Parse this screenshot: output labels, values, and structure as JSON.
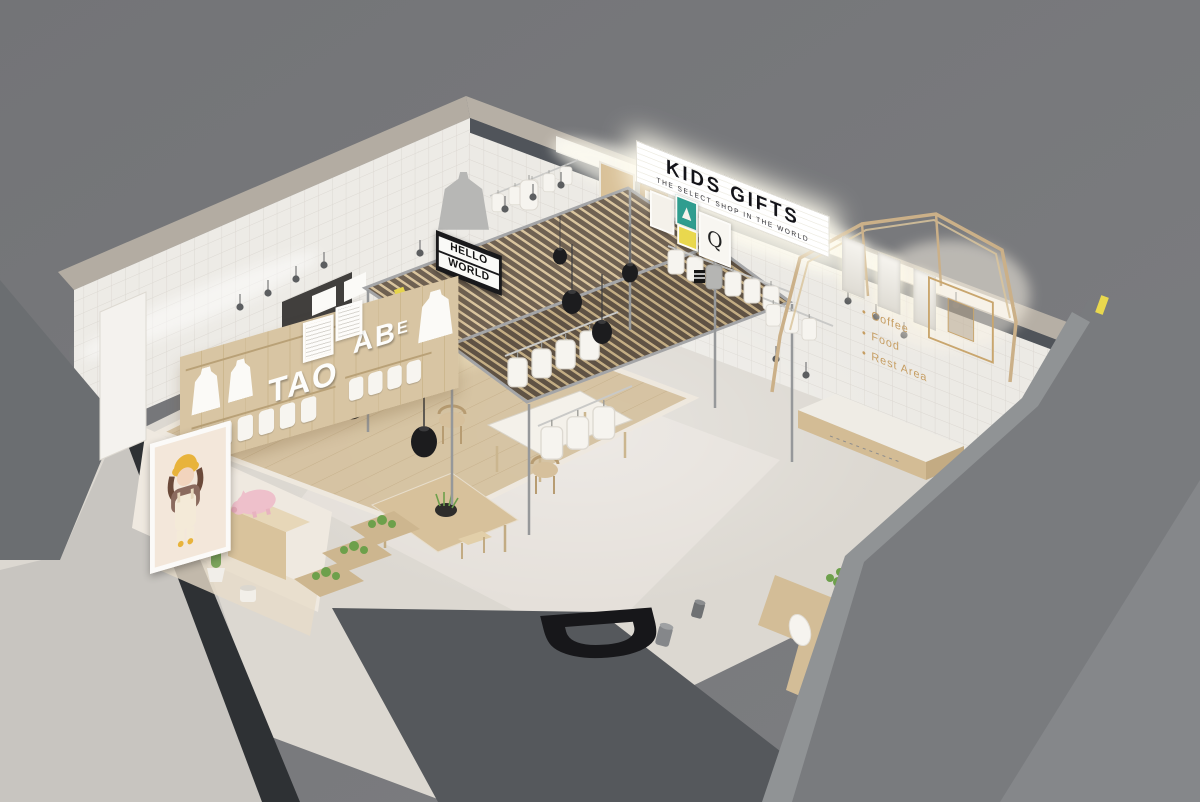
{
  "scene": {
    "description": "3D cutaway interior render of a kids' select shop"
  },
  "signs": {
    "marquee": {
      "title": "KIDS GIFTS",
      "subtitle": "THE SELECT SHOP IN THE WORLD"
    },
    "hanging": {
      "line1": "HELLO",
      "line2": "WORLD"
    },
    "display_letters": {
      "group1": "TAO",
      "group2": "AB",
      "group2_small": "E"
    },
    "artwork_letter": "Q",
    "amenity_list": {
      "bullet": "•",
      "items": [
        "Coffee",
        "Food",
        "Rest Area"
      ]
    },
    "floor_letter": "D"
  },
  "palette": {
    "background_grey": "#76777a",
    "cut_wall_grey": "#6b6e71",
    "glass_dark": "#2e3134",
    "tile_white": "#eceae5",
    "wood_light": "#d8c5a3",
    "wood_slat_dark": "#6f6152",
    "floor_concrete": "#dcd8d1",
    "steel_grey": "#9b9c9e",
    "signal_black": "#161616",
    "plant_green": "#6da04b",
    "accent_yellow": "#e9d84e",
    "accent_pink": "#eec0cb",
    "brand_gold": "#c69e63"
  }
}
